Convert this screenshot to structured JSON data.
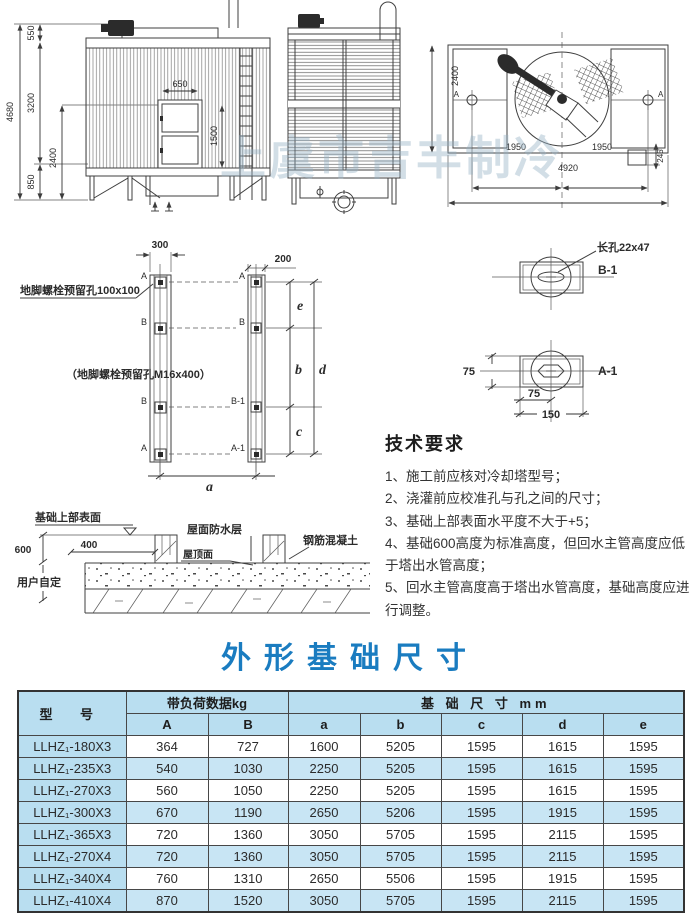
{
  "watermark": "上虞市吉丰制冷",
  "drawings": {
    "front_view": {
      "dims": {
        "total_height": "4680",
        "top": "550",
        "mid": "3200",
        "inner": "2400",
        "base": "850",
        "door_width": "650",
        "door_height": "1500"
      }
    },
    "plan_view": {
      "dims": {
        "depth": "2400",
        "left_span": "1950",
        "right_span": "1950",
        "total_width": "4920",
        "outlet": "245"
      },
      "labels": {
        "a_left": "A",
        "a_right": "A"
      }
    },
    "bolt_plan": {
      "dims": {
        "left_width": "300",
        "right_width": "200",
        "e": "e",
        "b": "b",
        "c": "c",
        "d": "d",
        "a": "a"
      },
      "labels": {
        "left": [
          "A",
          "B",
          "B",
          "A"
        ],
        "right": [
          "A",
          "B",
          "B-1",
          "A-1"
        ]
      },
      "note1": "地脚螺栓预留孔100x100",
      "note2": "（地脚螺栓预留孔M16x400）"
    },
    "detail_b1": {
      "title": "B-1",
      "note": "长孔22x47"
    },
    "detail_a1": {
      "title": "A-1",
      "dim_v": "75",
      "dim_h": "75",
      "dim_w": "150"
    },
    "section": {
      "label_surface": "基础上部表面",
      "dim_600": "600",
      "dim_400": "400",
      "label_user": "用户自定",
      "label_waterproof": "屋面防水层",
      "label_roof": "屋顶面",
      "label_concrete": "钢筋混凝土"
    }
  },
  "tech": {
    "heading": "技术要求",
    "items": [
      "1、施工前应核对冷却塔型号；",
      "2、浇灌前应校准孔与孔之间的尺寸；",
      "3、基础上部表面水平度不大于+5；",
      "4、基础600高度为标准高度，但回水主管高度应低于塔出水管高度；",
      "5、回水主管高度高于塔出水管高度，基础高度应进行调整。"
    ]
  },
  "title": "外形基础尺寸",
  "table": {
    "col_model": "型 号",
    "group_load": "带负荷数据kg",
    "group_foundation": "基 础 尺 寸 mm",
    "sub_headers": [
      "A",
      "B",
      "a",
      "b",
      "c",
      "d",
      "e"
    ],
    "rows": [
      {
        "model": "LLHZ₁-180X3",
        "A": "364",
        "B": "727",
        "a": "1600",
        "b": "5205",
        "c": "1595",
        "d": "1615",
        "e": "1595"
      },
      {
        "model": "LLHZ₁-235X3",
        "A": "540",
        "B": "1030",
        "a": "2250",
        "b": "5205",
        "c": "1595",
        "d": "1615",
        "e": "1595"
      },
      {
        "model": "LLHZ₁-270X3",
        "A": "560",
        "B": "1050",
        "a": "2250",
        "b": "5205",
        "c": "1595",
        "d": "1615",
        "e": "1595"
      },
      {
        "model": "LLHZ₁-300X3",
        "A": "670",
        "B": "1190",
        "a": "2650",
        "b": "5206",
        "c": "1595",
        "d": "1915",
        "e": "1595"
      },
      {
        "model": "LLHZ₁-365X3",
        "A": "720",
        "B": "1360",
        "a": "3050",
        "b": "5705",
        "c": "1595",
        "d": "2115",
        "e": "1595"
      },
      {
        "model": "LLHZ₁-270X4",
        "A": "720",
        "B": "1360",
        "a": "3050",
        "b": "5705",
        "c": "1595",
        "d": "2115",
        "e": "1595"
      },
      {
        "model": "LLHZ₁-340X4",
        "A": "760",
        "B": "1310",
        "a": "2650",
        "b": "5506",
        "c": "1595",
        "d": "1915",
        "e": "1595"
      },
      {
        "model": "LLHZ₁-410X4",
        "A": "870",
        "B": "1520",
        "a": "3050",
        "b": "5705",
        "c": "1595",
        "d": "2115",
        "e": "1595"
      }
    ]
  },
  "colors": {
    "accent_blue": "#1a7cc0",
    "table_header_blue": "#b9def0",
    "table_stripe_blue": "#c8e5f4",
    "line": "#3f3f3f"
  }
}
